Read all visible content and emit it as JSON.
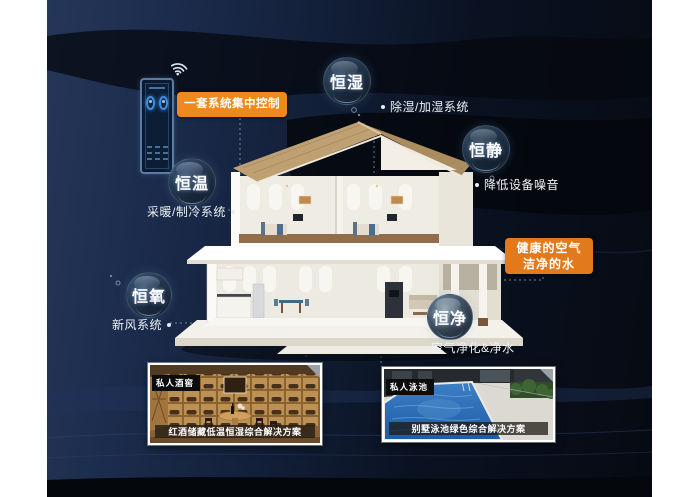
{
  "control": {
    "label": "一套系统集中控制"
  },
  "bubbles": [
    {
      "id": "hengshi",
      "label": "恒湿",
      "note": "除湿/加湿系统"
    },
    {
      "id": "hengjing",
      "label": "恒静",
      "note": "降低设备噪音"
    },
    {
      "id": "hengwen",
      "label": "恒温",
      "note": "采暖/制冷系统"
    },
    {
      "id": "hengyang",
      "label": "恒氧",
      "note": "新风系统"
    },
    {
      "id": "hengjin",
      "label": "恒净",
      "note": "空气净化&净水"
    }
  ],
  "highlight": {
    "line1": "健康的空气",
    "line2": "洁净的水"
  },
  "photos": [
    {
      "tag": "私人酒窖",
      "caption": "红酒储藏低温恒湿综合解决方案",
      "subject": "wine-cellar"
    },
    {
      "tag": "私人泳池",
      "caption": "别墅泳池绿色综合解决方案",
      "subject": "swimming-pool"
    }
  ],
  "icons": {
    "wifi": "wifi-icon",
    "phone": "smart-home-app-phone"
  },
  "colors": {
    "accent_orange": "#ED8A1F",
    "accent_orange_dark": "#E2791C",
    "bg_navy": "#1B2B4B",
    "bg_black": "#090D14",
    "pool_blue": "#2E6FB4",
    "wood": "#B4874C",
    "roof_tan": "#BFA073"
  }
}
